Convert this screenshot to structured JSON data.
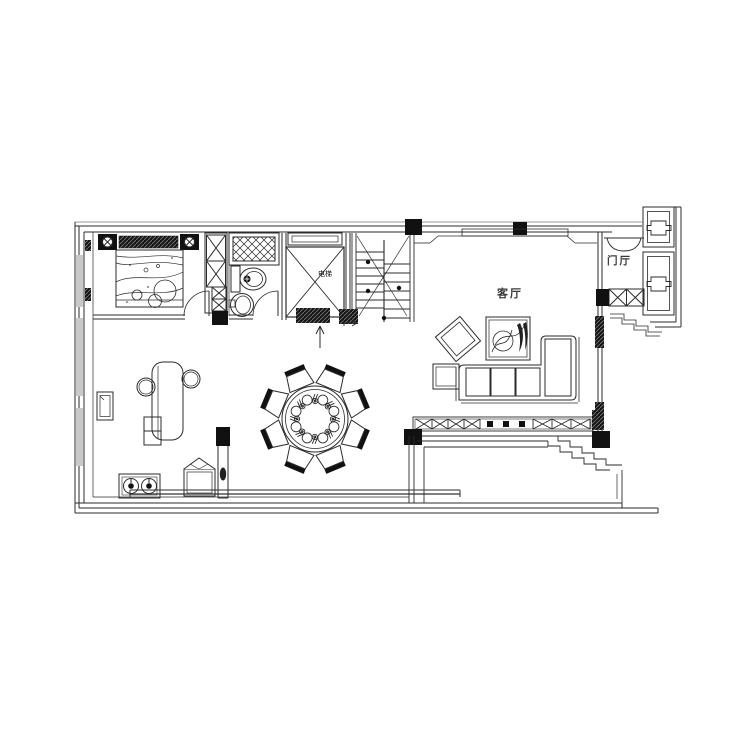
{
  "page": {
    "background": "#ffffff",
    "line_color": "#2b2b2b",
    "drawing_type": "residential floor plan"
  },
  "rooms": {
    "living_room": {
      "label": "客厅"
    },
    "foyer": {
      "label": "门厅"
    },
    "elevator": {
      "label": "电梯"
    }
  }
}
